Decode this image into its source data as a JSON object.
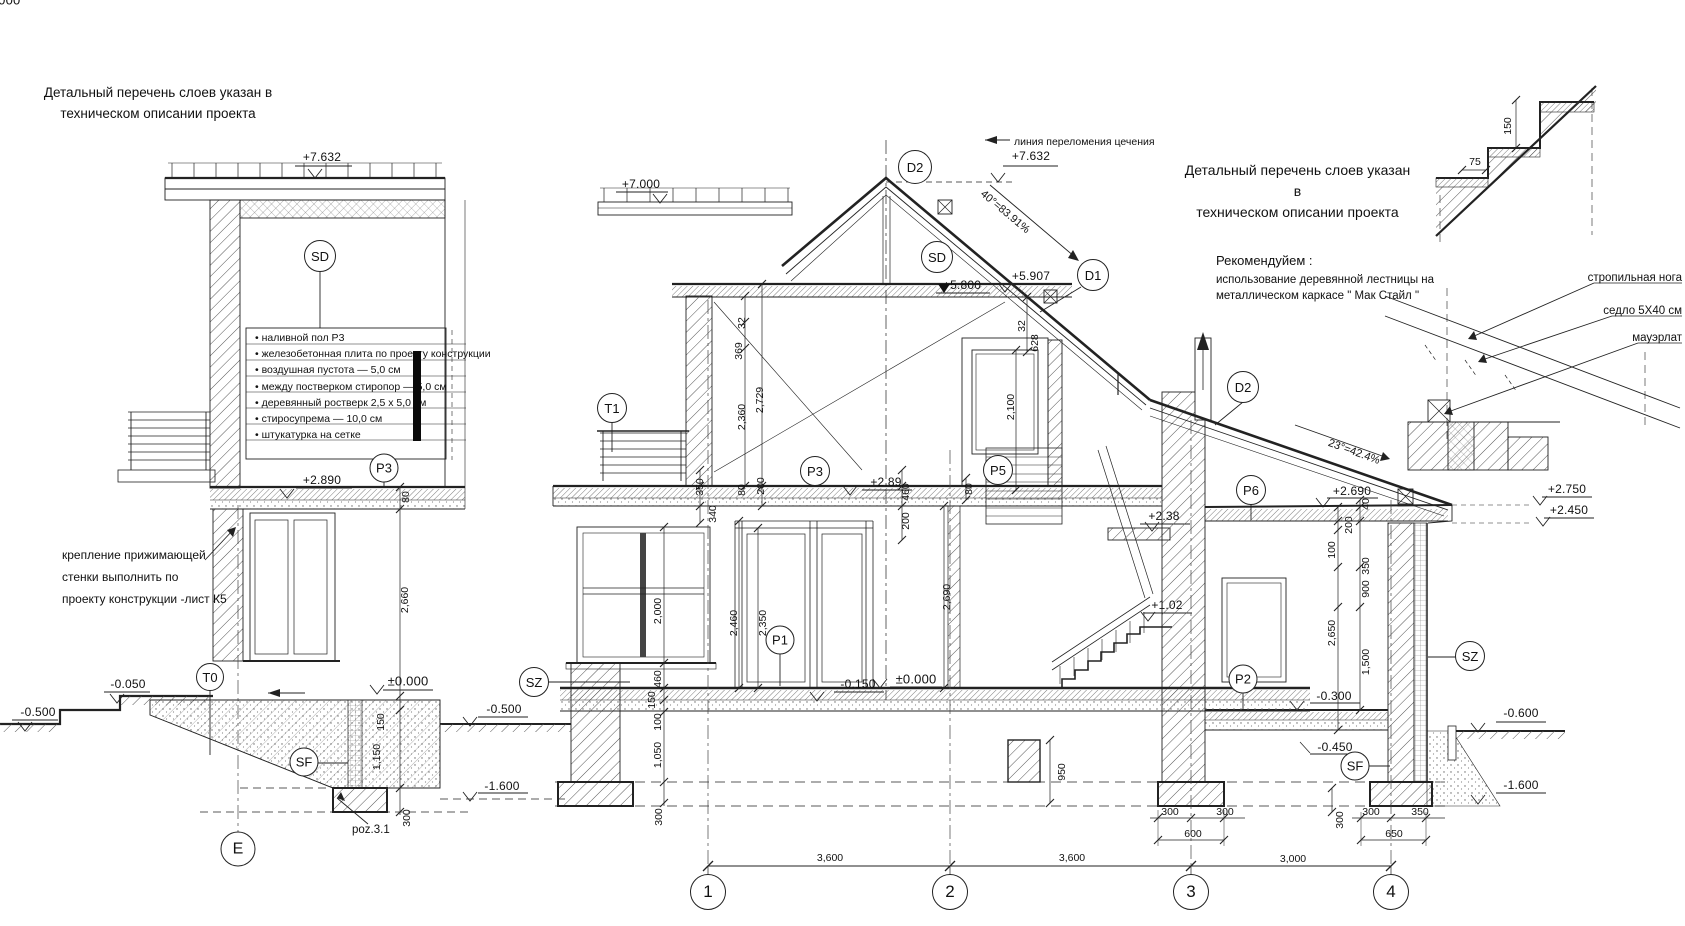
{
  "notes": {
    "layers_note_left": [
      "Детальный перечень слоев указан в",
      "техническом описании проекта"
    ],
    "layers_note_right": [
      "Детальный перечень слоев указан в",
      "техническом описании проекта"
    ],
    "recommend_title": "Рекомендуйем :",
    "recommend_body": [
      "использование деревянной лестницы на",
      "металлическом каркасе \" Мак  Стайл \""
    ],
    "section_break_line": "линия переломения цечения",
    "wall_fixing": [
      "крепление прижимающей",
      "стенки выполнить по",
      "проекту конструкции -лист К5"
    ],
    "poz_label": "poz.3.1"
  },
  "layer_list": [
    "• наливной пол Р3",
    "• железобетонная плита по проекту конструкции",
    "• воздушная пустота — 5,0 см",
    "• между постверком стиропор — 5,0 см",
    "• деревянный ростверк  2,5 х 5,0 см",
    "• стиросупрема — 10,0 см",
    "• штукатурка на сетке"
  ],
  "detail_labels": {
    "rafter_leg": "стропильная нога",
    "saddle": "седло 5Х40 см",
    "mauerlat": "мауэрлат"
  },
  "slopes": {
    "main_roof": "40°=83.91%",
    "low_roof": "23°=42.4%"
  },
  "bubbles": {
    "sd_left": "SD",
    "p3_left": "P3",
    "t0": "T0",
    "sf_left": "SF",
    "axis_e": "E",
    "d2_top": "D2",
    "sd_main": "SD",
    "d1": "D1",
    "t1": "T1",
    "p3_main": "P3",
    "p5": "P5",
    "d2_right": "D2",
    "p6": "P6",
    "p1": "P1",
    "p2": "P2",
    "sz_left": "SZ",
    "sz_right": "SZ",
    "sf_right": "SF",
    "axis_1": "1",
    "axis_2": "2",
    "axis_3": "3",
    "axis_4": "4"
  },
  "elevations": {
    "left_roof": "+7.632",
    "main_ridge": "+7.632",
    "canopy": "+7.000",
    "attic_floor": "+5.800",
    "attic_top": "+5.907",
    "left_floor": "+2.890",
    "main_floor1": "+2.89",
    "stair_ceiling": "+2.38",
    "stair_landing": "+1.02",
    "wing_ceiling": "+2.690",
    "eave_top": "+2.750",
    "eave_bottom": "+2.450",
    "zero_left": "±0.000",
    "zero_main": "±0.000",
    "terrace": "-0.050",
    "slab_drop": "-0.150",
    "wing_floor": "-0.300",
    "wing_sub": "-0.450",
    "ground_left_sec": "-0.500",
    "ground_left_main": "-0.500",
    "ground_right": "-0.600",
    "found_left_main": "-1.600",
    "found_right": "-1.600"
  },
  "dims": {
    "left_2660": "2,660",
    "left_80": "80",
    "left_150": "150",
    "left_1150": "1,150",
    "left_300": "300",
    "fl1_350": "350",
    "fl1_340": "340",
    "attic_32": "32",
    "attic_369": "369",
    "attic_2360": "2,360",
    "attic_2729": "2,729",
    "fl1_80": "80",
    "fl1_200": "200",
    "stair_460": "460",
    "stair_200": "200",
    "stair_80": "80",
    "stair_2690": "2,690",
    "p5_32": "32",
    "p5_628": "628",
    "p5_2100": "2,100",
    "win_2000": "2,000",
    "door_2460": "2,460",
    "door_2350": "2,350",
    "base_460": "460",
    "base_150": "150",
    "base_100": "100",
    "base_1050": "1,050",
    "base_300": "300",
    "pier_950": "950",
    "wing_40": "40",
    "wing_200": "200",
    "wing_100": "100",
    "wing_350": "350",
    "wing_900": "900",
    "wing_2650": "2,650",
    "wing_1500": "1,500",
    "wing_300v": "300",
    "f3_300a": "300",
    "f3_300b": "300",
    "f3_600": "600",
    "f4_300": "300",
    "f4_350": "350",
    "f4_650": "650",
    "span_12": "3,600",
    "span_23": "3,600",
    "span_34": "3,000",
    "stairdet_75": "75",
    "stairdet_150": "150"
  }
}
